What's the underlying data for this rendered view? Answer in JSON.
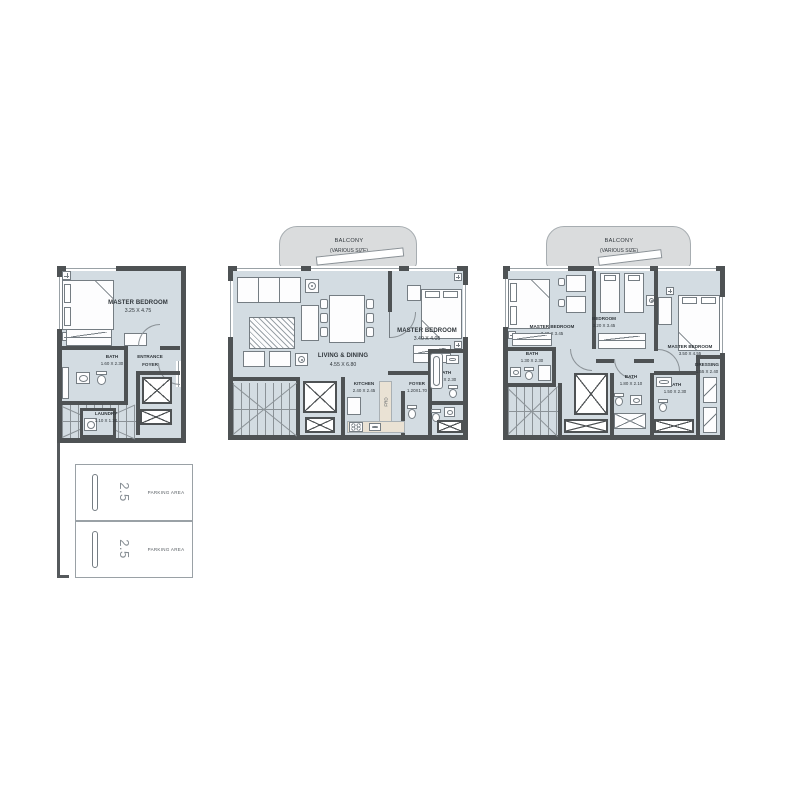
{
  "colors": {
    "floor": "#d3dce2",
    "wall": "#4e5254",
    "balcony_fill": "#dadcdd",
    "kitchen_counter": "#eae2d4",
    "furniture_line": "#757d83",
    "label_text": "#30363b"
  },
  "plans": {
    "ground": {
      "master_bedroom": {
        "name": "MASTER BEDROOM",
        "dims": "3.25 X 4.75"
      },
      "bath": {
        "name": "BATH",
        "dims": "1.60 X 2.30"
      },
      "entrance_foyer": {
        "line1": "ENTRANCE",
        "line2": "FOYER"
      },
      "laundry": {
        "name": "LAUNDRY",
        "dims": "1.10 X 1.20"
      },
      "parking": {
        "stall1": {
          "size": "2.5",
          "label": "PARKING AREA"
        },
        "stall2": {
          "size": "2.5",
          "label": "PARKING AREA"
        }
      }
    },
    "first": {
      "balcony": {
        "name": "BALCONY",
        "note": "(VARIOUS SIZE)"
      },
      "living_dining": {
        "name": "LIVING & DINING",
        "dims": "4.55 X 6.80"
      },
      "master_bedroom": {
        "name": "MASTER BEDROOM",
        "dims": "3.40 X 4.05"
      },
      "kitchen": {
        "name": "KITCHEN",
        "dims": "2.40 X 2.45"
      },
      "foyer": {
        "name": "FOYER",
        "dims": "1.20X1.70"
      },
      "bath": {
        "name": "BATH",
        "dims": "1.50 X 2.30"
      },
      "fridge_label": "FRD"
    },
    "second": {
      "balcony": {
        "name": "BALCONY",
        "note": "(VARIOUS SIZE)"
      },
      "master_bedroom_left": {
        "name": "MASTER BEDROOM",
        "dims": "3.40 X 3.45"
      },
      "bedroom": {
        "name": "BEDROOM",
        "dims": "3.20 X 3.45"
      },
      "master_bedroom_right": {
        "name": "MASTER BEDROOM",
        "dims": "3.50 X 4.55"
      },
      "bath_left": {
        "name": "BATH",
        "dims": "1.30 X 2.30"
      },
      "bath_middle": {
        "name": "BATH",
        "dims": "1.80 X 2.10"
      },
      "bath_right": {
        "name": "BATH",
        "dims": "1.50 X 2.30"
      },
      "dressing": {
        "name": "DRESSING",
        "dims": "1.55 X 2.40"
      }
    }
  }
}
